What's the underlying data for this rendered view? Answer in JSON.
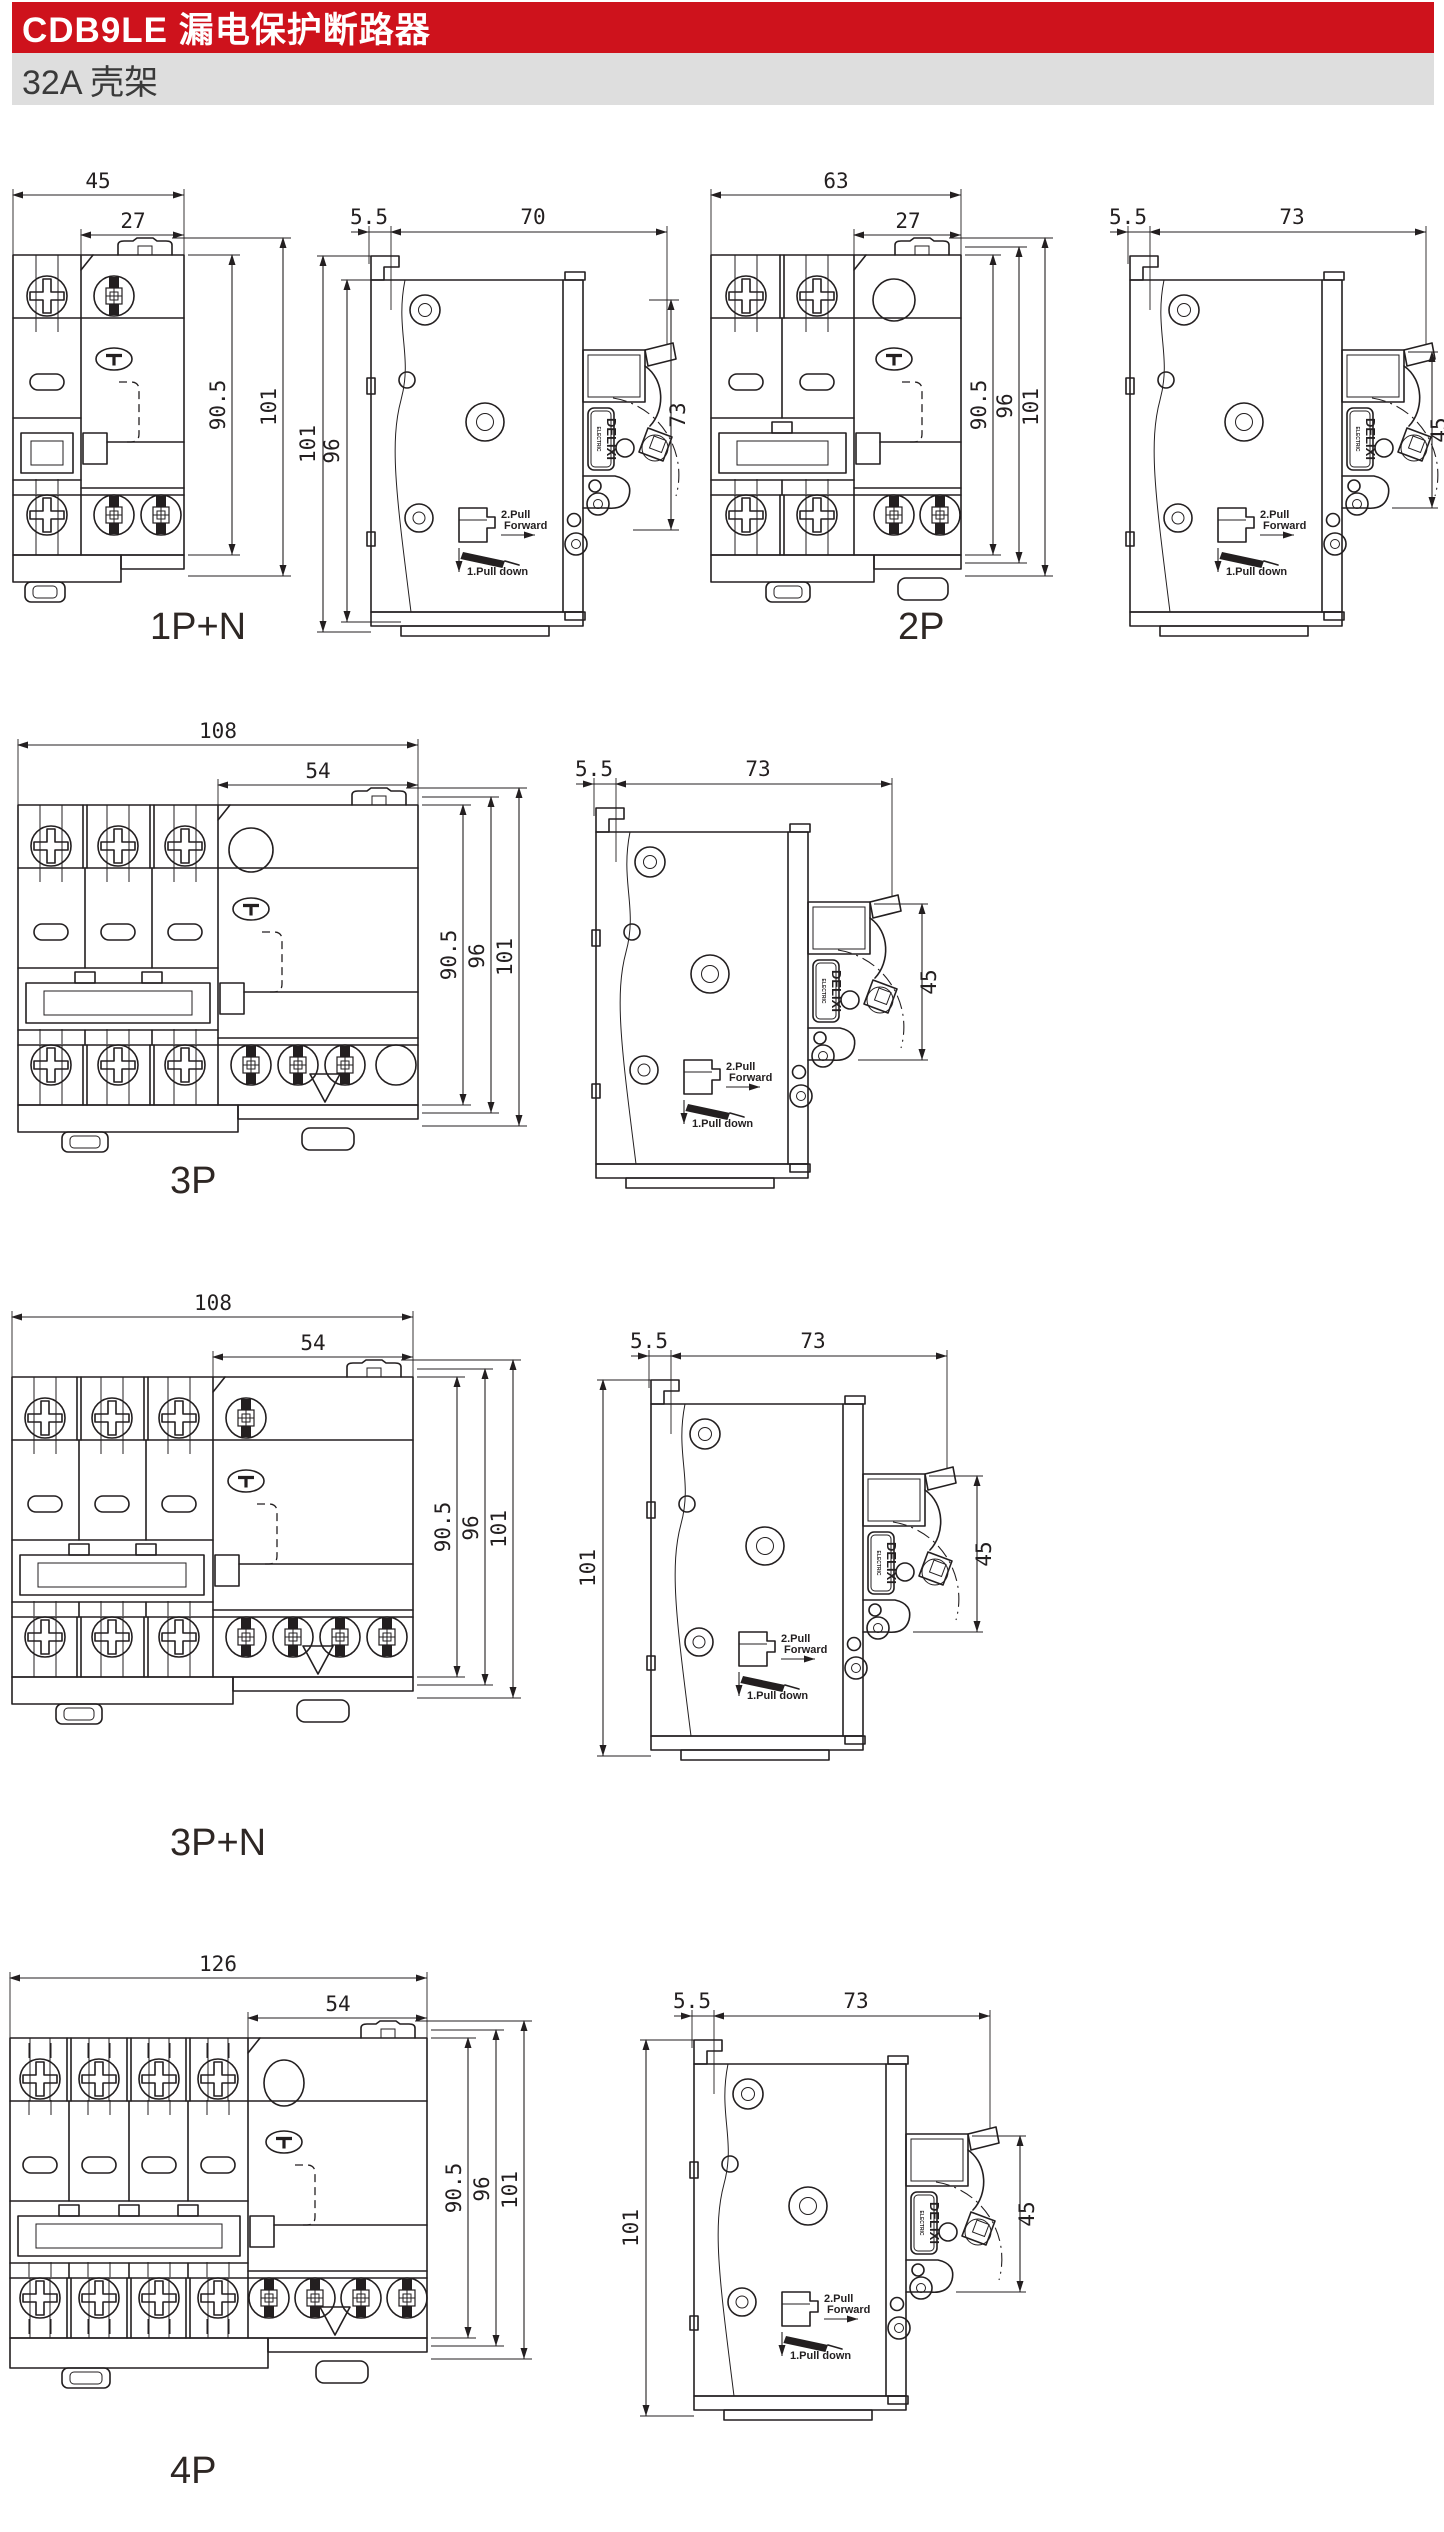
{
  "header": {
    "title": "CDB9LE 漏电保护断路器",
    "subtitle": "32A 壳架",
    "accent_color": "#ce121c",
    "subtitle_bg": "#dedede",
    "line_color": "#231f20"
  },
  "shared": {
    "brand_line1": "DELIXI",
    "brand_line2": "ELECTRIC",
    "pull_fwd_1": "2.Pull",
    "pull_fwd_2": "Forward",
    "pull_down": "1.Pull down"
  },
  "figures": [
    {
      "caption": "1P+N",
      "front": {
        "dim_total": "45",
        "dim_module": "27",
        "dim_h_body": "90.5",
        "dim_h_overall": "101"
      },
      "side": {
        "dim_rail": "5.5",
        "dim_depth": "70",
        "dim_right": "73",
        "dim_left_outer": "101",
        "dim_left_inner": "96"
      }
    },
    {
      "caption": "2P",
      "front": {
        "dim_total": "63",
        "dim_module": "27",
        "dim_h_body": "90.5",
        "dim_h_mid": "96",
        "dim_h_overall": "101"
      },
      "side": {
        "dim_rail": "5.5",
        "dim_depth": "73",
        "dim_right": "45"
      }
    },
    {
      "caption": "3P",
      "front": {
        "dim_total": "108",
        "dim_module": "54",
        "dim_h_body": "90.5",
        "dim_h_mid": "96",
        "dim_h_overall": "101"
      },
      "side": {
        "dim_rail": "5.5",
        "dim_depth": "73",
        "dim_right": "45"
      }
    },
    {
      "caption": "3P+N",
      "front": {
        "dim_total": "108",
        "dim_module": "54",
        "dim_h_body": "90.5",
        "dim_h_mid": "96",
        "dim_h_overall": "101"
      },
      "side": {
        "dim_rail": "5.5",
        "dim_depth": "73",
        "dim_right": "45",
        "dim_left_outer": "101"
      }
    },
    {
      "caption": "4P",
      "front": {
        "dim_total": "126",
        "dim_module": "54",
        "dim_h_body": "90.5",
        "dim_h_mid": "96",
        "dim_h_overall": "101"
      },
      "side": {
        "dim_rail": "5.5",
        "dim_depth": "73",
        "dim_right": "45",
        "dim_left_outer": "101"
      }
    }
  ]
}
